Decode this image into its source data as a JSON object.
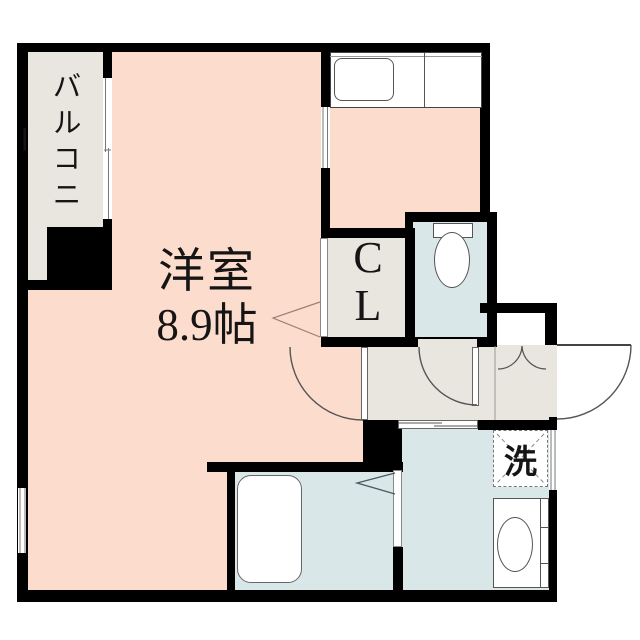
{
  "plan_title": "one-room apartment floor plan",
  "rooms": {
    "balcony_label": "バルコニー",
    "main_room_label": "洋室",
    "main_room_size": "8.9帖",
    "closet_letter_top": "C",
    "closet_letter_bottom": "L",
    "laundry_label": "洗"
  },
  "fixtures": [
    "kitchen-counter",
    "kitchen-sink",
    "toilet",
    "bathtub",
    "washbasin",
    "washing-machine-space",
    "entrance-door",
    "storage-double-doors",
    "room-swing-door",
    "toilet-swing-door",
    "sliding-door",
    "folding-bath-door",
    "balcony-window",
    "room-side-window",
    "washroom-window",
    "partition-window"
  ],
  "colors": {
    "room": "#fcdccc",
    "service": "#e8e6de",
    "wet": "#d9e7e9",
    "wall": "#000000",
    "outside": "#ffffff"
  }
}
